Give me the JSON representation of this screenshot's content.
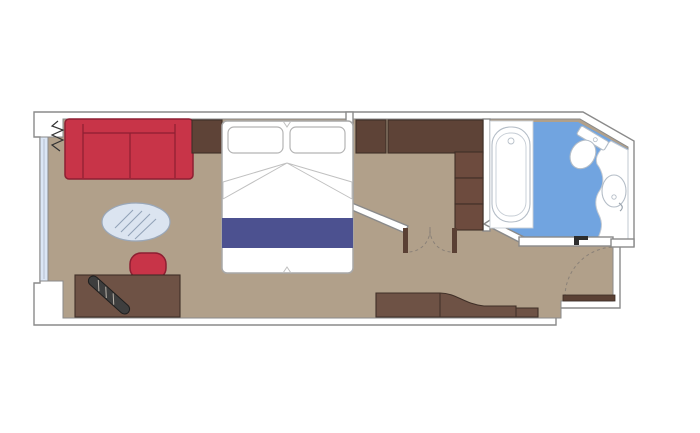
{
  "plan": {
    "kind": "cruise-ship-cabin-floor-plan",
    "rooms": [
      {
        "name": "living-sleeping-area"
      },
      {
        "name": "entry-corridor-with-wardrobe"
      },
      {
        "name": "bathroom"
      },
      {
        "name": "entrance-vestibule"
      },
      {
        "name": "balcony-window-side"
      }
    ],
    "furniture": [
      "sofa",
      "curtain",
      "coffee-table",
      "desk-chair",
      "desk",
      "desk-accessory",
      "double-bed",
      "pillow-left",
      "pillow-right",
      "bed-runner",
      "bedside-table-left",
      "bedside-table-right",
      "wardrobe",
      "wardrobe-shelves",
      "double-swing-door",
      "bathtub",
      "toilet",
      "washbasin",
      "vanity-counter",
      "storage-cabinet",
      "entrance-door",
      "bathroom-door-frame"
    ]
  },
  "colors": {
    "background": "#ffffff",
    "wall_fill": "#ffffff",
    "wall_line": "#8a8a8a",
    "floor": "#b1a08a",
    "wood": "#6e5245",
    "wood_dark": "#5e4337",
    "shelf_wood": "#6d4b3e",
    "door_leaf": "#5a4034",
    "red": "#c83448",
    "red_dark": "#8d1f32",
    "bed_white": "#ffffff",
    "runner_blue": "#4c5190",
    "bathroom_blue": "#71a4e0",
    "window_glass": "#dbe6f5",
    "table_glass": "#dbe4f0",
    "accessory_dark": "#3e3e3e"
  }
}
